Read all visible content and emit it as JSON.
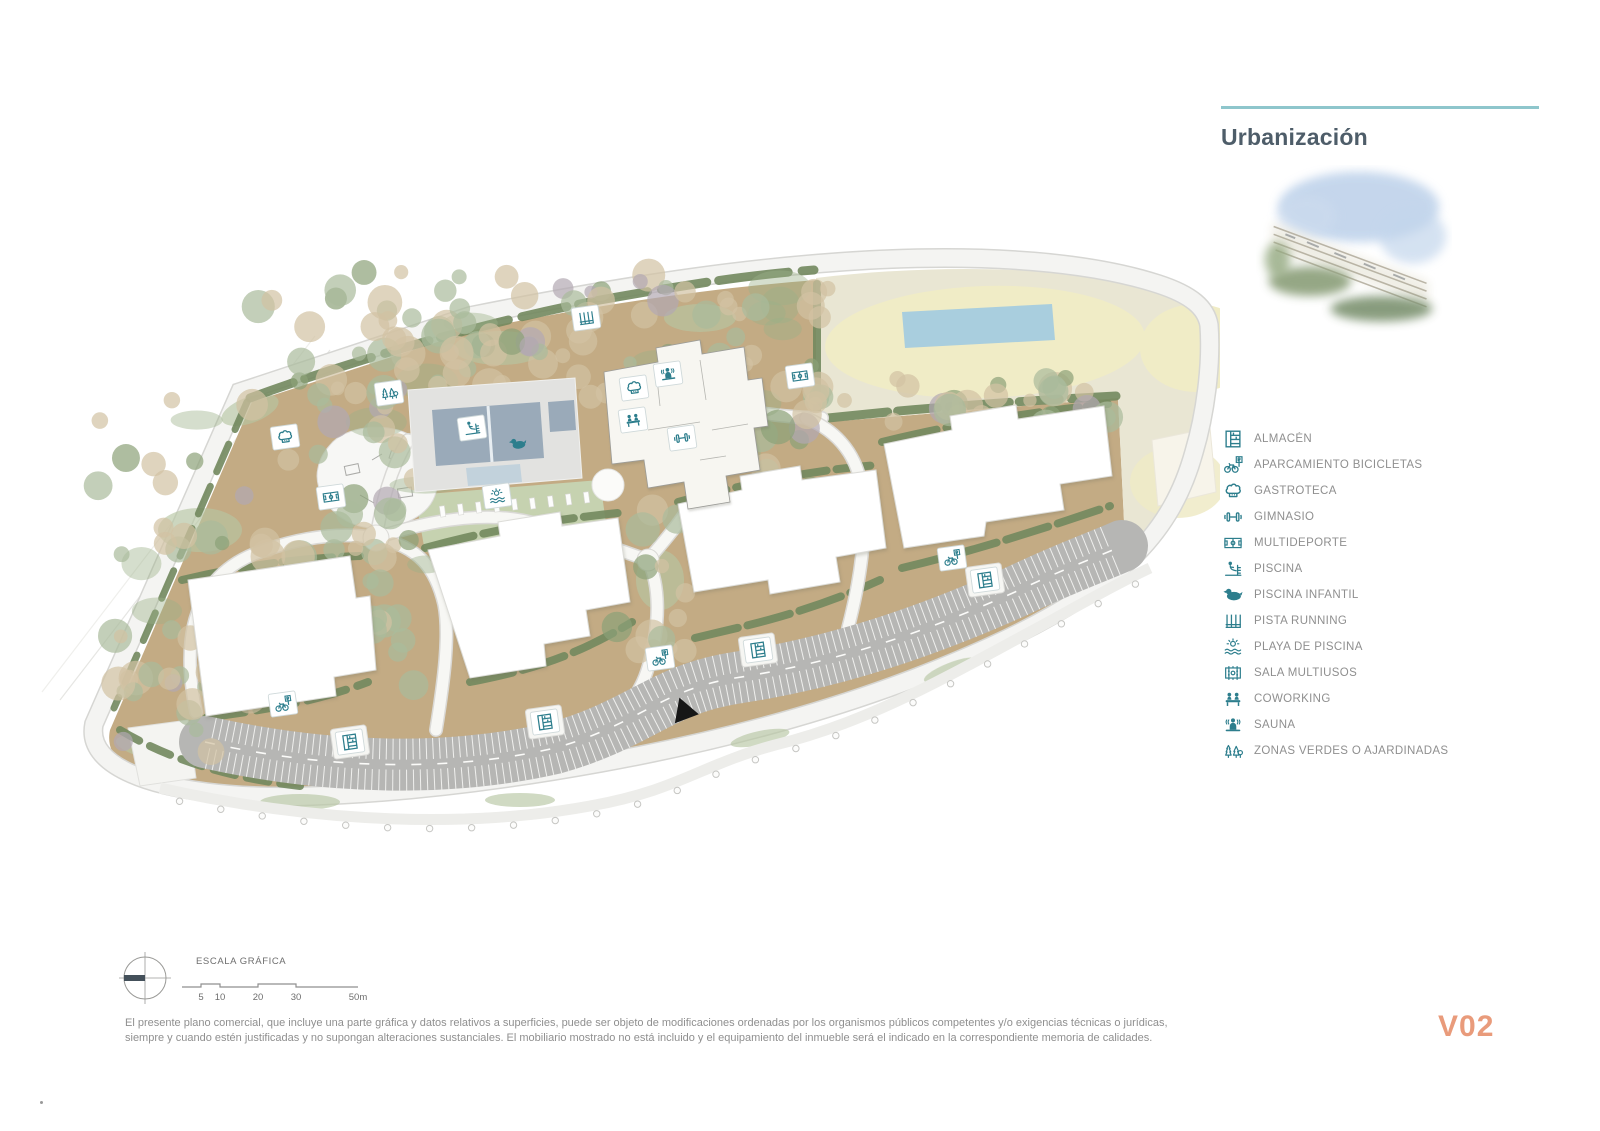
{
  "page": {
    "title": "Urbanización",
    "version_label": "V02",
    "scale_label": "ESCALA GRÁFICA",
    "scale_ticks": [
      "5",
      "10",
      "20",
      "30",
      "50m"
    ],
    "disclaimer": "El presente plano comercial, que incluye una parte gráfica y datos relativos a superficies, puede ser objeto de modificaciones ordenadas por los organismos públicos competentes y/o exigencias técnicas o jurídicas, siempre y cuando estén justificadas y no supongan alteraciones sustanciales. El mobiliario mostrado no está incluido y el equipamiento del inmueble será el indicado en la correspondiente memoria de calidades."
  },
  "colors": {
    "accent_teal": "#2d7e8d",
    "rule_teal": "#8ec6cc",
    "title_text": "#4e5d69",
    "legend_text": "#8f8f8f",
    "version_orange": "#e99b7b",
    "ground_brown": "#c3ab84",
    "hedge_green": "#72885e",
    "tree_green": "#a9bb9b",
    "tree_tan": "#d2c2a2",
    "beige_zone": "#e9e6d3",
    "sand_oval": "#f0ecc6",
    "water_blue": "#a9cede",
    "pool_water": "#9aaab9",
    "parking_gray": "#b6b6b4"
  },
  "legend": {
    "items": [
      {
        "icon": "almacen",
        "label": "ALMACÉN"
      },
      {
        "icon": "bicicletas",
        "label": "APARCAMIENTO BICICLETAS"
      },
      {
        "icon": "gastroteca",
        "label": "GASTROTECA"
      },
      {
        "icon": "gimnasio",
        "label": "GIMNASIO"
      },
      {
        "icon": "multideporte",
        "label": "MULTIDEPORTE"
      },
      {
        "icon": "piscina",
        "label": "PISCINA"
      },
      {
        "icon": "piscina-infantil",
        "label": "PISCINA INFANTIL"
      },
      {
        "icon": "pista-running",
        "label": "PISTA RUNNING"
      },
      {
        "icon": "playa-piscina",
        "label": "PLAYA DE PISCINA"
      },
      {
        "icon": "sala-multiusos",
        "label": "SALA MULTIUSOS"
      },
      {
        "icon": "coworking",
        "label": "COWORKING"
      },
      {
        "icon": "sauna",
        "label": "SAUNA"
      },
      {
        "icon": "zonas-verdes",
        "label": "ZONAS VERDES O AJARDINADAS"
      }
    ]
  },
  "map": {
    "icons": [
      {
        "icon": "pista-running",
        "x": 586,
        "y": 88
      },
      {
        "icon": "zonas-verdes",
        "x": 389,
        "y": 163
      },
      {
        "icon": "gastroteca",
        "x": 285,
        "y": 207
      },
      {
        "icon": "multideporte",
        "x": 331,
        "y": 267
      },
      {
        "icon": "piscina",
        "x": 472,
        "y": 198
      },
      {
        "icon": "piscina-infantil",
        "x": 518,
        "y": 214,
        "boxed": false
      },
      {
        "icon": "playa-piscina",
        "x": 497,
        "y": 266
      },
      {
        "icon": "gastroteca",
        "x": 634,
        "y": 158
      },
      {
        "icon": "sauna",
        "x": 668,
        "y": 144
      },
      {
        "icon": "coworking",
        "x": 633,
        "y": 190
      },
      {
        "icon": "gimnasio",
        "x": 682,
        "y": 208
      },
      {
        "icon": "multideporte",
        "x": 800,
        "y": 146
      },
      {
        "icon": "bicicletas",
        "x": 283,
        "y": 474
      },
      {
        "icon": "bicicletas",
        "x": 660,
        "y": 428
      },
      {
        "icon": "bicicletas",
        "x": 952,
        "y": 328
      },
      {
        "icon": "almacen",
        "x": 350,
        "y": 512,
        "kiosk": true
      },
      {
        "icon": "almacen",
        "x": 545,
        "y": 492,
        "kiosk": true
      },
      {
        "icon": "almacen",
        "x": 758,
        "y": 420,
        "kiosk": true
      },
      {
        "icon": "almacen",
        "x": 985,
        "y": 350,
        "kiosk": true
      }
    ]
  }
}
